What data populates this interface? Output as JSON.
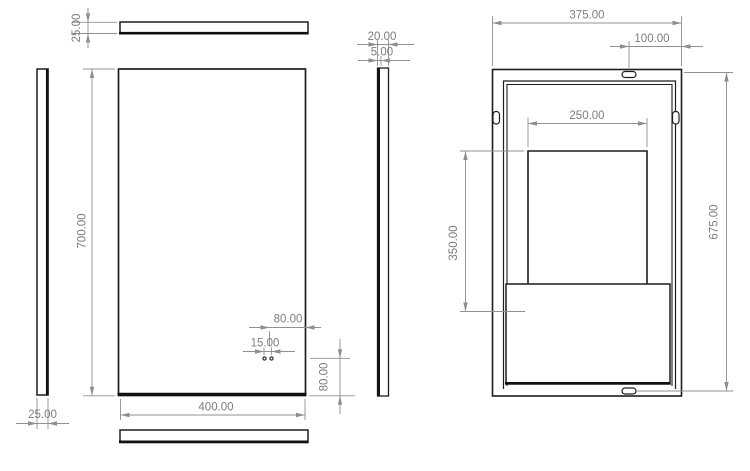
{
  "drawing": {
    "type": "cad-multiview-dimensioned-drawing",
    "background": "#ffffff",
    "colors": {
      "part_edge": "#1d1d1d",
      "dimension_line": "#909090",
      "dimension_text": "#7d7d7d"
    },
    "views": {
      "top_bar": {
        "label": "top thickness view",
        "thickness": "25.00"
      },
      "left_bar": {
        "label": "left thickness view",
        "thickness": "25.00"
      },
      "front": {
        "label": "front panel view",
        "height": "700.00",
        "width": "400.00",
        "hole_to_edge": "80.00",
        "hole_spacing": "15.00",
        "hole_to_bottom": "80.00"
      },
      "side": {
        "label": "side section view",
        "depth": "20.00",
        "sheet_thickness": "5.00"
      },
      "bottom_bar": {
        "label": "bottom thickness view"
      },
      "back": {
        "label": "back frame view",
        "width": "375.00",
        "slot_to_edge": "100.00",
        "opening_width": "250.00",
        "opening_depth": "350.00",
        "slot_span": "675.00"
      }
    }
  }
}
